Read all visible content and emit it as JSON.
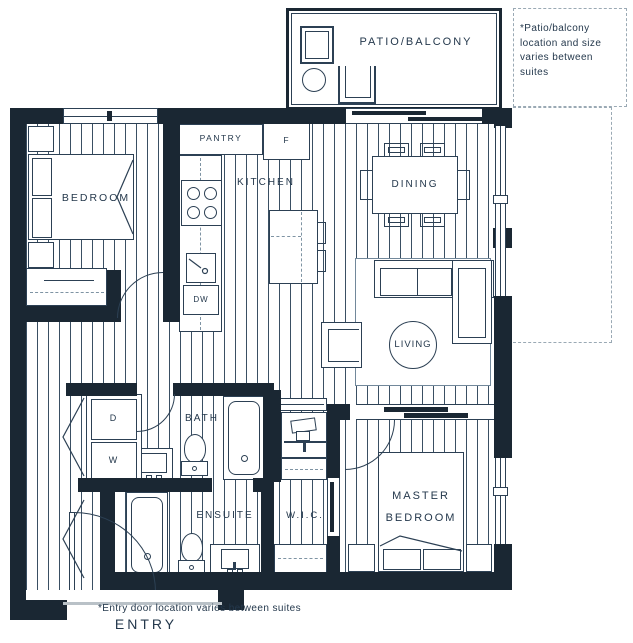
{
  "palette": {
    "wall": "#1a2733",
    "line": "#2c4054",
    "hatch": "#3a4f63",
    "text": "#24384c",
    "dashed_outline": "#9aa9b4"
  },
  "rooms": {
    "patio": "PATIO/BALCONY",
    "bedroom": "BEDROOM",
    "pantry": "PANTRY",
    "kitchen": "KITCHEN",
    "dining": "DINING",
    "living": "LIVING",
    "bath": "BATH",
    "ensuite": "ENSUITE",
    "wic": "W.I.C.",
    "master_line1": "MASTER",
    "master_line2": "BEDROOM",
    "entry": "ENTRY"
  },
  "appliances": {
    "fridge": "F",
    "dishwasher": "DW",
    "dryer": "D",
    "washer": "W"
  },
  "notes": {
    "patio": "*Patio/balcony location and size varies between suites",
    "entry": "*Entry door location varies between suites"
  }
}
